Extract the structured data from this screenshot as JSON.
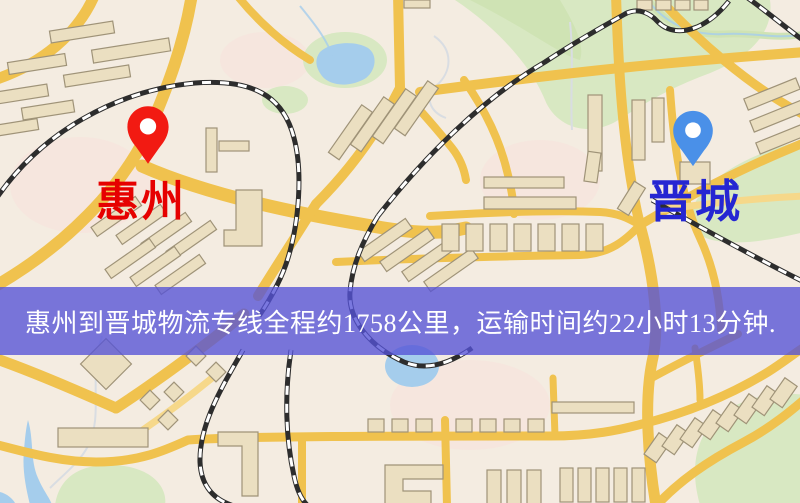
{
  "banner": {
    "text": "惠州到晋城物流专线全程约1758公里，运输时间约22小时13分钟."
  },
  "markers": {
    "origin": {
      "label": "惠州"
    },
    "destination": {
      "label": "晋城"
    }
  },
  "colors": {
    "banner_bg": "#5452D6",
    "banner_text": "#FFFFFF",
    "origin_label": "#E60000",
    "origin_pin": "#F21A12",
    "destination_label": "#2526D2",
    "destination_pin": "#4A90E8",
    "road": "#F0C24E",
    "road_light": "#F6D88A",
    "building": "#EBDFC1",
    "building_outline": "#9F9378",
    "park": "#D8E8C2",
    "water": "#A5CDEC",
    "map_bg": "#F4ECE1",
    "rail": "#2D2D2D"
  }
}
